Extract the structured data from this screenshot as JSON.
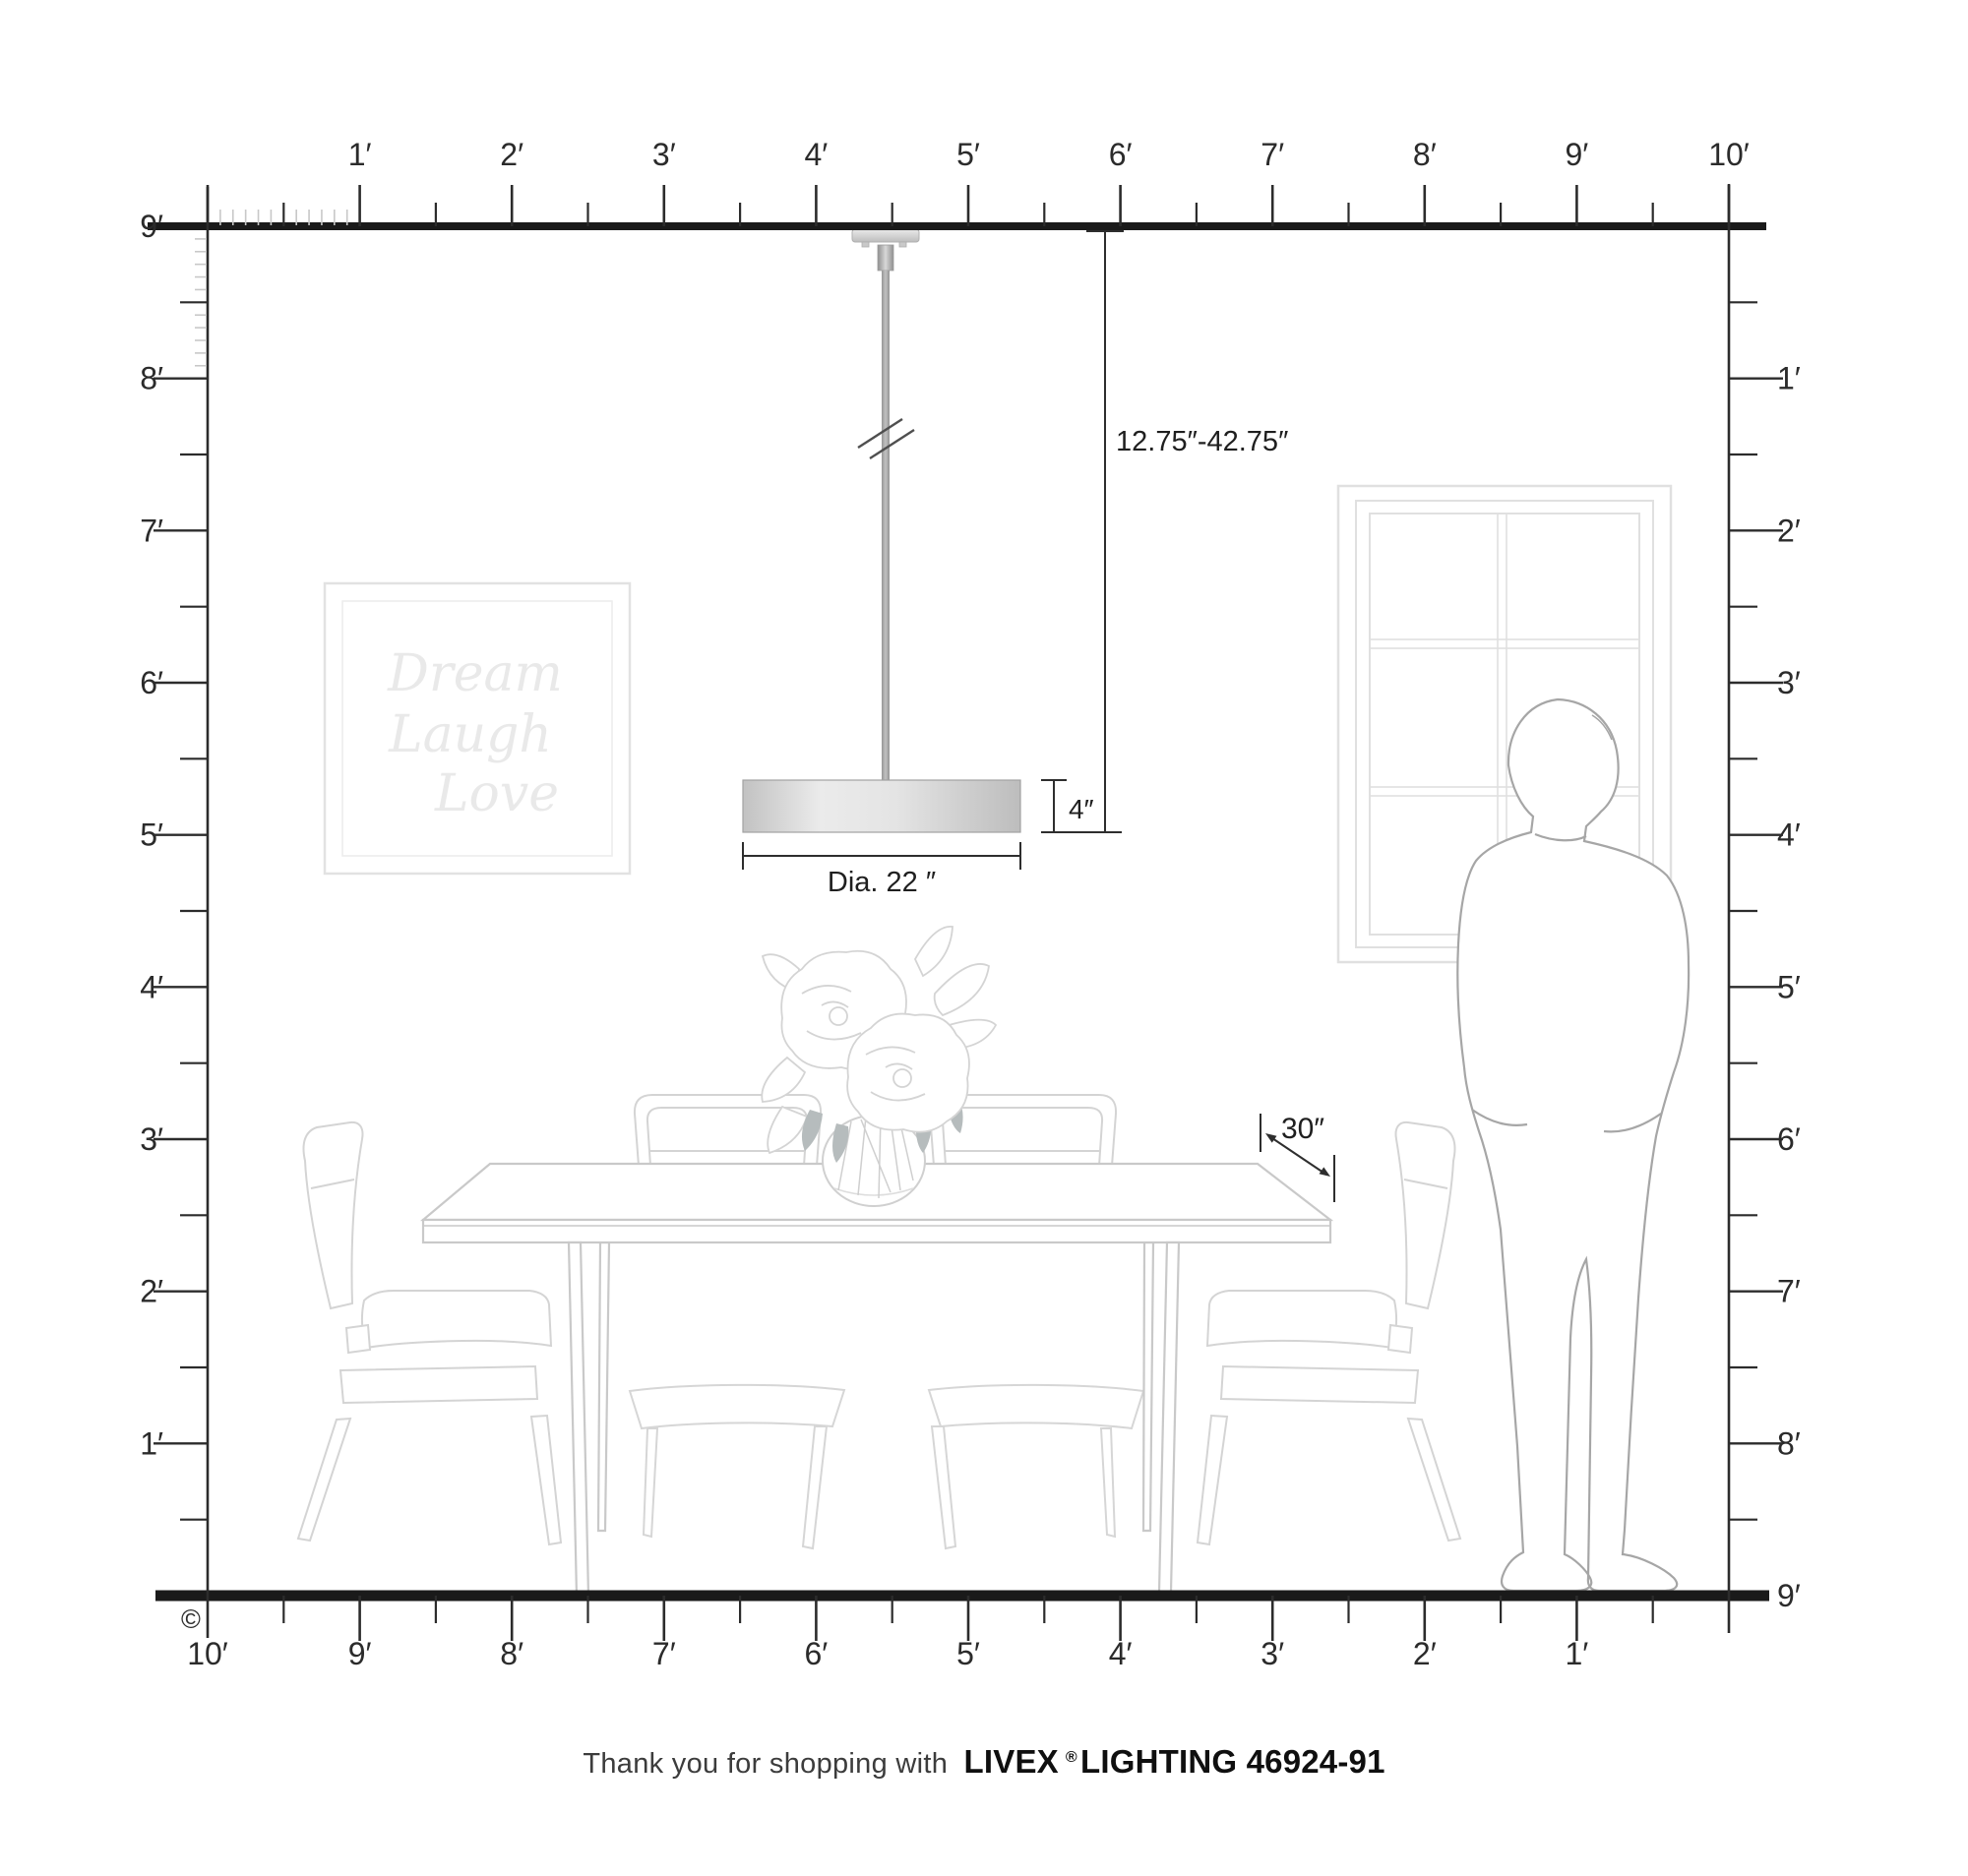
{
  "rulers": {
    "top": {
      "labels": [
        "1′",
        "2′",
        "3′",
        "4′",
        "5′",
        "6′",
        "7′",
        "8′",
        "9′",
        "10′"
      ]
    },
    "bottom": {
      "labels": [
        "10′",
        "9′",
        "8′",
        "7′",
        "6′",
        "5′",
        "4′",
        "3′",
        "2′",
        "1′"
      ]
    },
    "left": {
      "labels": [
        "9′",
        "8′",
        "7′",
        "6′",
        "5′",
        "4′",
        "3′",
        "2′",
        "1′"
      ]
    },
    "right": {
      "labels": [
        "1′",
        "2′",
        "3′",
        "4′",
        "5′",
        "6′",
        "7′",
        "8′",
        "9′"
      ]
    }
  },
  "annotations": {
    "drop_range": "12.75″-42.75″",
    "shade_height": "4″",
    "shade_diameter": "Dia. 22 ″",
    "mount_height": "30″"
  },
  "wall_art": {
    "line1": "Dream",
    "line2": "Laugh",
    "line3": "Love"
  },
  "footer": {
    "prefix": "Thank you for shopping with",
    "brand": "LIVEX",
    "registered": "®",
    "product": "LIGHTING 46924-91"
  },
  "copyright": "©",
  "colors": {
    "ruler_line": "#1a1a1a",
    "tick_dark": "#2c2c2c",
    "tick_inch": "#c8c8c8",
    "dimension": "#2e2e2e",
    "furniture_line": "#d2d2d2",
    "person_line": "#a6a6a6",
    "metal_gray": "#a9a9a9"
  }
}
